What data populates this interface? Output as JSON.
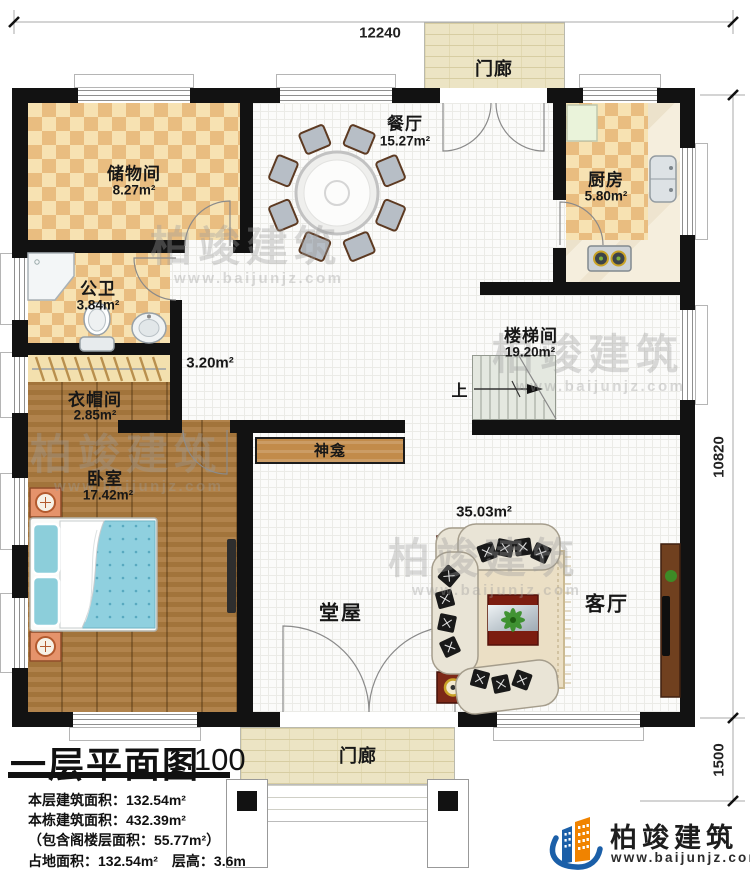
{
  "plan": {
    "dimensions": {
      "top": "12240",
      "right": "10820",
      "bottom_right": "1500"
    },
    "rooms": {
      "storage": {
        "name": "储物间",
        "area": "8.27m²"
      },
      "dining": {
        "name": "餐厅",
        "area": "15.27m²"
      },
      "kitchen": {
        "name": "厨房",
        "area": "5.80m²"
      },
      "bathroom": {
        "name": "公卫",
        "area": "3.84m²"
      },
      "corridor": {
        "area": "3.20m²"
      },
      "cloakroom": {
        "name": "衣帽间",
        "area": "2.85m²"
      },
      "bedroom": {
        "name": "卧室",
        "area": "17.42m²"
      },
      "stairwell": {
        "name": "楼梯间",
        "area": "19.20m²"
      },
      "hall": {
        "name": "堂屋",
        "area": "35.03m²"
      },
      "living": {
        "name": "客厅"
      },
      "shrine": {
        "name": "神龛"
      },
      "porch_top": {
        "name": "门廊"
      },
      "porch_bottom": {
        "name": "门廊"
      },
      "stairs_up": "上"
    }
  },
  "title_block": {
    "title": "一层平面图",
    "scale": "1:100",
    "stats": [
      "本层建筑面积：132.54m²",
      "本栋建筑面积：432.39m²",
      "（包含阁楼层面积：55.77m²）",
      "占地面积：132.54m²　层高：3.6m"
    ]
  },
  "branding": {
    "company": "柏竣建筑",
    "website": "www.baijunjz.com"
  },
  "watermark": {
    "text": "柏竣建筑",
    "url": "www.baijunjz.com"
  },
  "colors": {
    "wall": "#121212",
    "checker_tan": "#e9bd80",
    "checker_cream": "#f7e2b2",
    "wood": "#ab7a3e",
    "porch": "#ece4c4",
    "logo_blue": "#1b5fa8",
    "logo_orange": "#f08300"
  }
}
